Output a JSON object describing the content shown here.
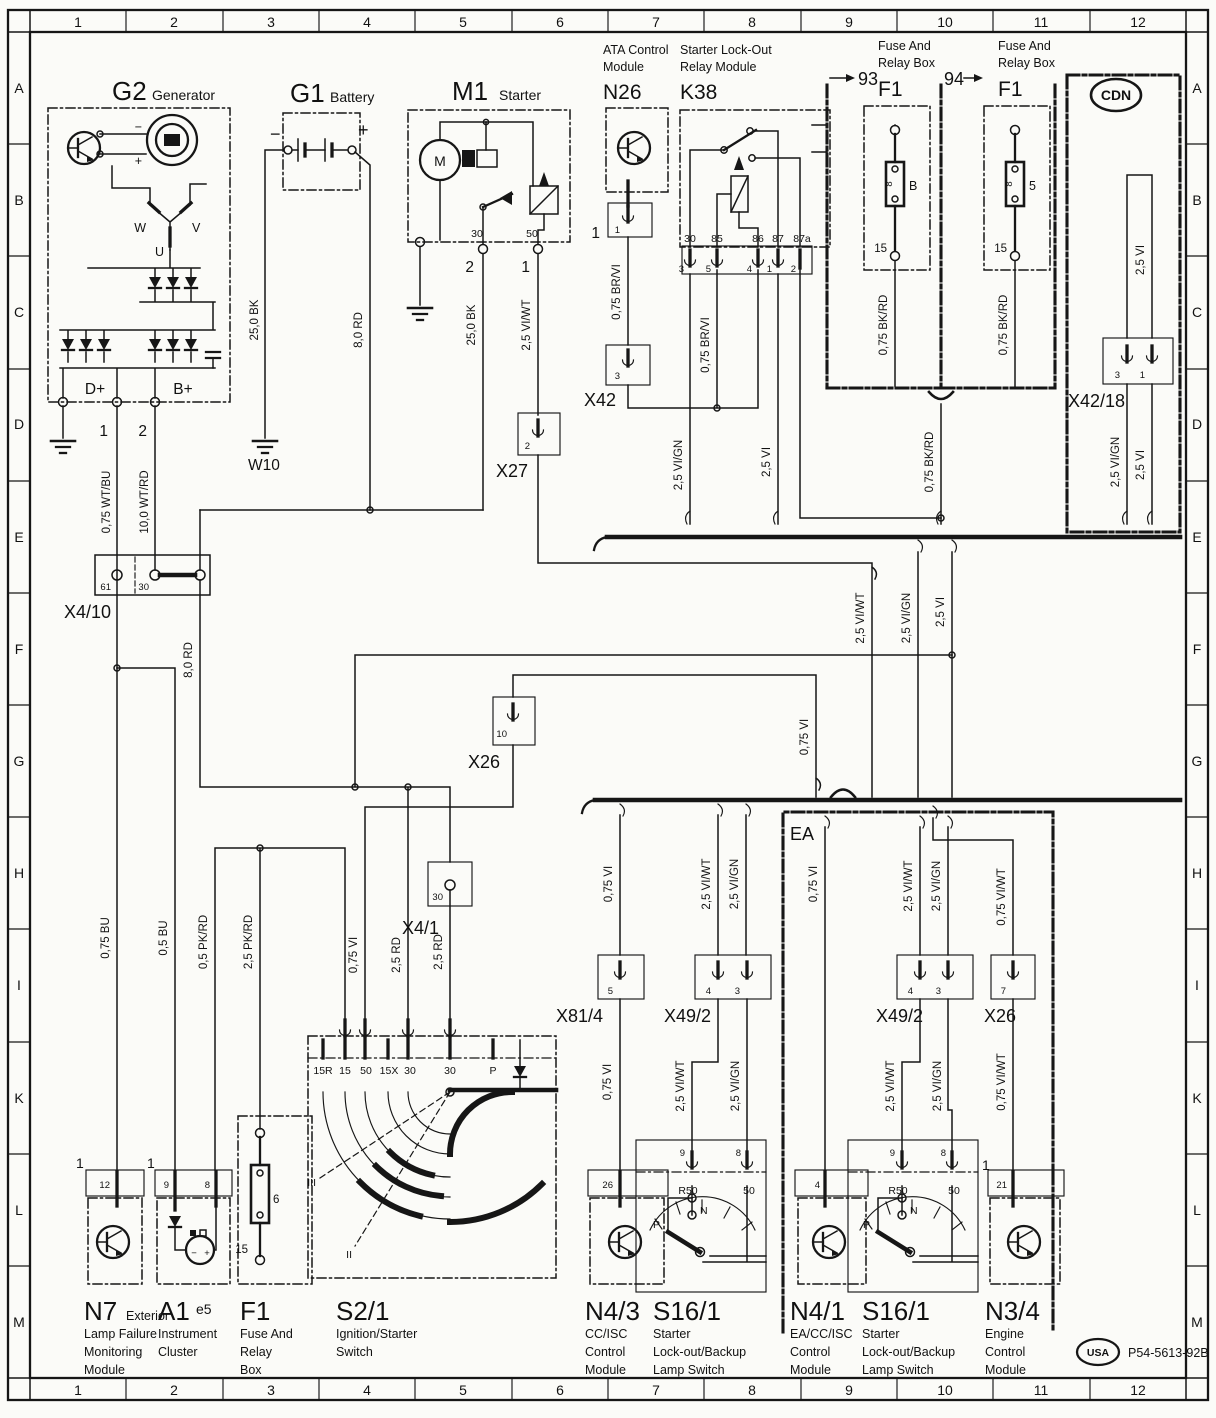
{
  "page": {
    "part_number": "P54-5613-92B",
    "usa_badge": "USA",
    "cdn_badge": "CDN",
    "ea_label": "EA"
  },
  "grid": {
    "cols": [
      "1",
      "2",
      "3",
      "4",
      "5",
      "6",
      "7",
      "8",
      "9",
      "10",
      "11",
      "12"
    ],
    "rows": [
      "A",
      "B",
      "C",
      "D",
      "E",
      "F",
      "G",
      "H",
      "I",
      "K",
      "L",
      "M"
    ]
  },
  "components": {
    "g2": {
      "id": "G2",
      "name": "Generator",
      "d_plus": "D+",
      "b_plus": "B+",
      "w": "W",
      "v": "V",
      "u": "U",
      "pin1": "1",
      "pin2": "2",
      "minus": "−",
      "plus": "+"
    },
    "g1": {
      "id": "G1",
      "name": "Battery",
      "minus": "−",
      "plus": "+"
    },
    "w10": {
      "id": "W10"
    },
    "m1": {
      "id": "M1",
      "name": "Starter",
      "motor": "M",
      "t30": "30",
      "t50": "50",
      "pin2": "2",
      "pin1": "1"
    },
    "n26": {
      "id": "N26",
      "name_l1": "ATA Control",
      "name_l2": "Module",
      "pin_big": "1",
      "pin": "1"
    },
    "x42": {
      "id": "X42",
      "pin": "3"
    },
    "x27": {
      "id": "X27",
      "pin": "2"
    },
    "k38": {
      "id": "K38",
      "name_l1": "Starter Lock-Out",
      "name_l2": "Relay Module",
      "t30": "30",
      "t85": "85",
      "t86": "86",
      "t87": "87",
      "t87a": "87a",
      "p3": "3",
      "p5": "5",
      "p4": "4",
      "p1": "1",
      "p2": "2"
    },
    "fuse93": {
      "num": "93",
      "name_l1": "Fuse And",
      "name_l2": "Relay Box",
      "id": "F1",
      "fuse": "8",
      "letter": "B",
      "t15": "15"
    },
    "fuse94": {
      "num": "94",
      "name_l1": "Fuse And",
      "name_l2": "Relay Box",
      "id": "F1",
      "fuse": "8",
      "letter": "5",
      "t15": "15"
    },
    "x42_18": {
      "id": "X42/18",
      "p3": "3",
      "p1": "1"
    },
    "x4_10": {
      "id": "X4/10",
      "t61": "61",
      "t30": "30"
    },
    "x26_mid": {
      "id": "X26",
      "pin": "10"
    },
    "x4_1": {
      "id": "X4/1",
      "t30": "30"
    },
    "x81_4": {
      "id": "X81/4",
      "pin": "5"
    },
    "x49_2_left": {
      "id": "X49/2",
      "p4": "4",
      "p3": "3"
    },
    "x49_2_right": {
      "id": "X49/2",
      "p4": "4",
      "p3": "3"
    },
    "x26_right": {
      "id": "X26",
      "pin": "7"
    },
    "s2_1": {
      "id": "S2/1",
      "name_l1": "Ignition/Starter",
      "name_l2": "Switch",
      "t": [
        "15R",
        "15",
        "50",
        "15X",
        "30",
        "30",
        "P"
      ],
      "pos_iii": "III",
      "pos_ii": "II"
    },
    "f1_bottom": {
      "id": "F1",
      "name_l1": "Fuse And",
      "name_l2": "Relay",
      "name_l3": "Box",
      "fuse": "6",
      "t15": "15"
    },
    "n7": {
      "id": "N7",
      "name_s": "Exterior",
      "l2": "Lamp Failure",
      "l3": "Monitoring",
      "l4": "Module",
      "pin_big": "1",
      "pin": "12"
    },
    "a1": {
      "id": "A1",
      "sub": "e5",
      "l2": "Instrument",
      "l3": "Cluster",
      "pin_big": "1",
      "p9": "9",
      "p8": "8",
      "minus": "−",
      "plus": "+"
    },
    "n4_3": {
      "id": "N4/3",
      "l2": "CC/ISC",
      "l3": "Control",
      "l4": "Module",
      "pin": "26"
    },
    "s16_1_left": {
      "id": "S16/1",
      "l2": "Starter",
      "l3": "Lock-out/Backup",
      "l4": "Lamp Switch",
      "p9": "9",
      "p8": "8",
      "r50": "R50",
      "t50": "50",
      "p": "P",
      "n": "N"
    },
    "n4_1": {
      "id": "N4/1",
      "l2": "EA/CC/ISC",
      "l3": "Control",
      "l4": "Module",
      "pin": "4"
    },
    "s16_1_right": {
      "id": "S16/1",
      "l2": "Starter",
      "l3": "Lock-out/Backup",
      "l4": "Lamp Switch",
      "p9": "9",
      "p8": "8",
      "r50": "R50",
      "t50": "50",
      "p": "P",
      "n": "N",
      "pin_big": "1"
    },
    "n3_4": {
      "id": "N3/4",
      "l2": "Engine",
      "l3": "Control",
      "l4": "Module",
      "pin": "21"
    }
  },
  "wires": {
    "wt_bu": "0,75 WT/BU",
    "wt_rd": "10,0 WT/RD",
    "bk25_g1": "25,0 BK",
    "rd8_g1": "8,0 RD",
    "bk25_m1": "25,0 BK",
    "viwt25_m1": "2,5 VI/WT",
    "brvi_n26": "0,75 BR/VI",
    "brvi_k38": "0,75 BR/VI",
    "vign_k38": "2,5 VI/GN",
    "vi_k38": "2,5 VI",
    "bkrd_93": "0,75 BK/RD",
    "bkrd_94": "0,75 BK/RD",
    "vi_cdn_top": "2,5 VI",
    "vign_cdn": "2,5 VI/GN",
    "vi_cdn": "2,5 VI",
    "bkrd_bus": "0,75 BK/RD",
    "viwt_e": "2,5 VI/WT",
    "vign_e": "2,5 VI/GN",
    "vi_e": "2,5 VI",
    "rd8_mid": "8,0 RD",
    "vi_x26": "0,75 VI",
    "bu075": "0,75 BU",
    "bu05": "0,5 BU",
    "pkrd05": "0,5 PK/RD",
    "pkrd25": "2,5 PK/RD",
    "vi_s50": "0,75 VI",
    "rd25_a": "2,5 RD",
    "rd25_b": "2,5 RD",
    "vi_x81": "0,75 VI",
    "viwt_x49l": "2,5 VI/WT",
    "vign_x49l": "2,5 VI/GN",
    "vi_ea": "0,75 VI",
    "viwt_x49r": "2,5 VI/WT",
    "vign_x49r": "2,5 VI/GN",
    "viwt_x26r": "0,75 VI/WT",
    "vi_n43": "0,75 VI",
    "viwt_s16l": "2,5 VI/WT",
    "vign_s16l": "2,5 VI/GN",
    "viwt_s16r": "2,5 VI/WT",
    "vign_s16r": "2,5 VI/GN",
    "viwt_n34": "0,75 VI/WT"
  }
}
